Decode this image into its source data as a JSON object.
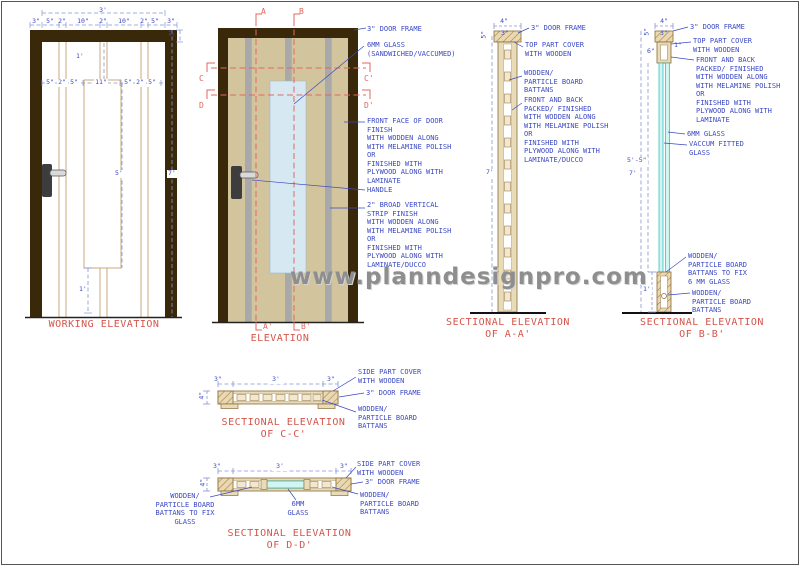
{
  "page": {
    "watermark": "www.planndesignpro.com"
  },
  "working_elevation": {
    "title": "WORKING ELEVATION",
    "dim_overall": "3'",
    "dim_top_row": [
      "3\"",
      "5\"",
      "2\"",
      "10\"",
      "2\"",
      "10\"",
      "2\"",
      "5\"",
      "3\""
    ],
    "dim_mid_row": [
      "5\"",
      "2\"",
      "5\"",
      "11\"",
      "5\"",
      "2\"",
      "5\""
    ],
    "dim_top_inset": "1'",
    "dim_frame": "3\"",
    "dim_glass_h": "5'",
    "dim_height": "7'",
    "dim_bottom": "1'"
  },
  "elevation": {
    "title": "ELEVATION",
    "marker_a": "A",
    "marker_b": "B",
    "marker_a2": "A'",
    "marker_b2": "B'",
    "marker_c": "C",
    "marker_d": "D",
    "marker_c2": "C'",
    "marker_d2": "D'",
    "anno_frame": "3\" DOOR FRAME",
    "anno_glass": [
      "6MM GLASS",
      "(SANDWICHED/VACCUMED)"
    ],
    "anno_front": [
      "FRONT FACE OF DOOR",
      "FINISH",
      "WITH WODDEN ALONG",
      "WITH MELAMINE POLISH",
      "OR",
      "FINISHED WITH",
      "PLYWOOD ALONG WITH",
      "LAMINATE"
    ],
    "anno_handle": "HANDLE",
    "anno_strip": [
      "2\" BROAD VERTICAL",
      "STRIP FINISH",
      "WITH WODDEN ALONG",
      "WITH MELAMINE POLISH",
      "OR",
      "FINISHED WITH",
      "PLYWOOD ALONG WITH",
      "LAMINATE/DUCCO"
    ]
  },
  "section_aa": {
    "title": [
      "SECTIONAL ELEVATION",
      "OF A-A'"
    ],
    "dim_w": "4\"",
    "dim_frame": "3\"",
    "dim_top": "5\"",
    "dim_height": "7'",
    "anno_frame": "3\" DOOR FRAME",
    "anno_cover": [
      "TOP PART COVER",
      "WITH WOODEN"
    ],
    "anno_battens": [
      "WODDEN/",
      "PARTICLE BOARD",
      "BATTANS"
    ],
    "anno_faces": [
      "FRONT AND BACK",
      "PACKED/ FINISHED",
      "WITH WODDEN ALONG",
      "WITH MELAMINE POLISH",
      "OR",
      "FINISHED WITH",
      "PLYWOOD ALONG WITH",
      "LAMINATE/DUCCO"
    ]
  },
  "section_bb": {
    "title": [
      "SECTIONAL ELEVATION",
      "OF B-B'"
    ],
    "dim_w": "4\"",
    "dim_frame": "3\"",
    "dim_top": "5\"",
    "dim_cover": "6\"",
    "dim_one": "1\"",
    "dim_glass_h": "5'-5\"",
    "dim_height": "7'",
    "dim_bottom": "1'",
    "anno_frame": "3\" DOOR FRAME",
    "anno_cover": [
      "TOP PART COVER",
      "WITH WOODEN"
    ],
    "anno_faces": [
      "FRONT AND BACK",
      "PACKED/ FINISHED",
      "WITH WODDEN ALONG",
      "WITH MELAMINE POLISH",
      "OR",
      "FINISHED WITH",
      "PLYWOOD ALONG WITH",
      "LAMINATE"
    ],
    "anno_glass": "6MM GLASS",
    "anno_vaccum": [
      "VACCUM FITTED",
      "GLASS"
    ],
    "anno_batten_glass": [
      "WODDEN/",
      "PARTICLE BOARD",
      "BATTANS TO FIX",
      "6 MM GLASS"
    ],
    "anno_battens": [
      "WODDEN/",
      "PARTICLE BOARD",
      "BATTANS"
    ]
  },
  "section_cc": {
    "title": [
      "SECTIONAL ELEVATION",
      "OF C-C'"
    ],
    "dim_left": "3\"",
    "dim_mid": "3'",
    "dim_right": "3\"",
    "dim_h": "4\"",
    "anno_cover": [
      "SIDE PART COVER",
      "WITH WOODEN"
    ],
    "anno_frame": "3\" DOOR FRAME",
    "anno_battens": [
      "WODDEN/",
      "PARTICLE BOARD",
      "BATTANS"
    ]
  },
  "section_dd": {
    "title": [
      "SECTIONAL ELEVATION",
      "OF D-D'"
    ],
    "dim_left": "3\"",
    "dim_mid": "3'",
    "dim_right": "3\"",
    "dim_h": "4\"",
    "anno_batten_glass": [
      "WODDEN/",
      "PARTICLE BOARD",
      "BATTANS TO FIX",
      "GLASS"
    ],
    "anno_glass": [
      "6MM",
      "GLASS"
    ],
    "anno_cover": [
      "SIDE PART COVER",
      "WITH WOODEN"
    ],
    "anno_frame": "3\" DOOR FRAME",
    "anno_battens": [
      "WODDEN/",
      "PARTICLE BOARD",
      "BATTANS"
    ]
  }
}
